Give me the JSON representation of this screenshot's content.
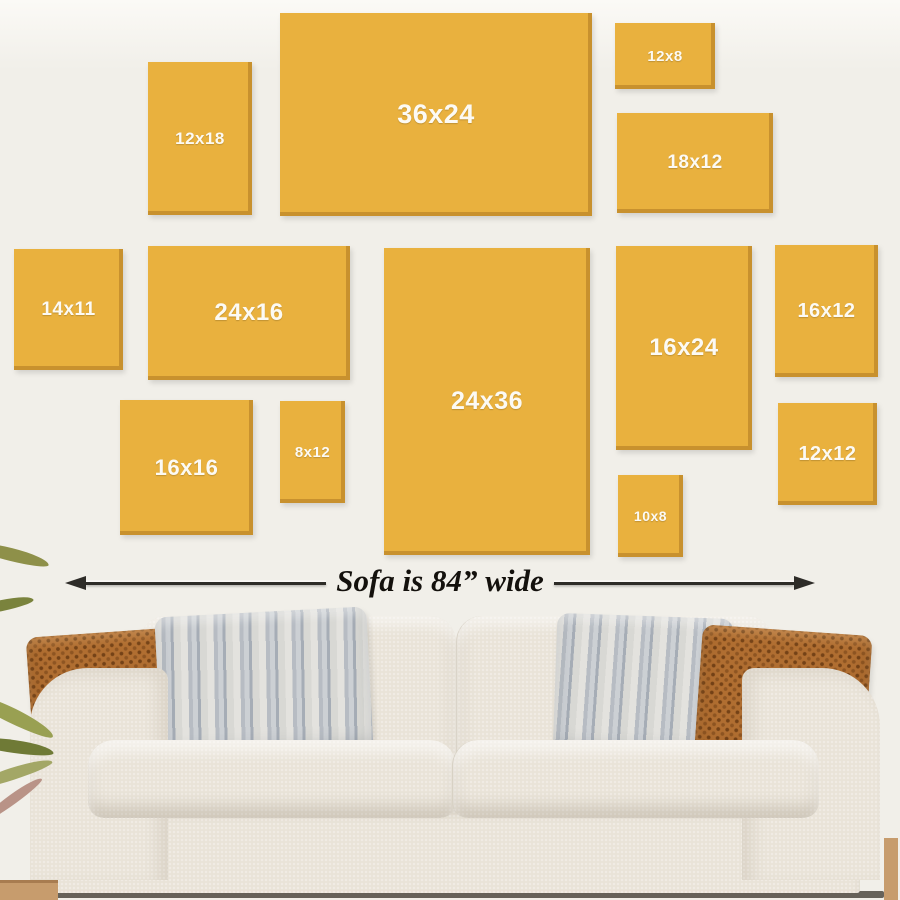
{
  "frames": [
    {
      "label": "12x18"
    },
    {
      "label": "36x24"
    },
    {
      "label": "12x8"
    },
    {
      "label": "18x12"
    },
    {
      "label": "14x11"
    },
    {
      "label": "24x16"
    },
    {
      "label": "24x36"
    },
    {
      "label": "16x24"
    },
    {
      "label": "16x12"
    },
    {
      "label": "12x12"
    },
    {
      "label": "16x16"
    },
    {
      "label": "8x12"
    },
    {
      "label": "10x8"
    }
  ],
  "arrow": {
    "label": "Sofa is 84” wide"
  },
  "colors": {
    "wall": "#f1efe9",
    "frame": "#e9b13e",
    "label_text": "#fcfaf4",
    "arrow_dark": "#2e2c28",
    "sofa": "#e9e3d8",
    "pillow_brown": "#b06e31",
    "floor_line": "#57524a",
    "wood": "#c79c6d"
  }
}
